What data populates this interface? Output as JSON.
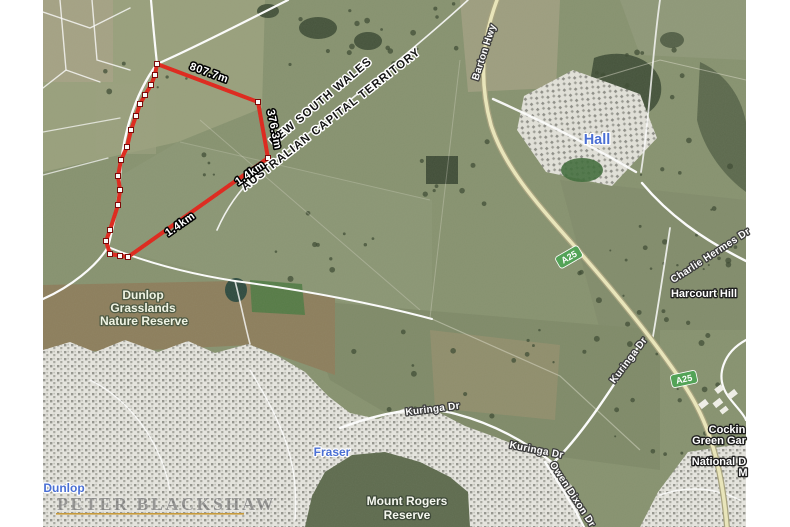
{
  "map": {
    "border_labels": [
      {
        "name": "state-label-nsw",
        "type": "border",
        "text": "NEW SOUTH WALES",
        "x": 323,
        "y": 104,
        "rotate": -40
      },
      {
        "name": "state-label-act",
        "type": "border",
        "text": "AUSTRALIAN CAPITAL TERRITORY",
        "x": 333,
        "y": 122,
        "rotate": -38
      }
    ],
    "measurements": [
      {
        "name": "measurement-807-7m",
        "type": "measure",
        "text": "807.7m",
        "x": 208,
        "y": 76,
        "rotate": 20
      },
      {
        "name": "measurement-376-3m",
        "type": "measure",
        "text": "376.3m",
        "x": 271,
        "y": 130,
        "rotate": 79
      },
      {
        "name": "measurement-1-4km-a",
        "type": "measure",
        "text": "1.4km",
        "x": 252,
        "y": 176,
        "rotate": -35
      },
      {
        "name": "measurement-1-4km-b",
        "type": "measure",
        "text": "1.4km",
        "x": 182,
        "y": 227,
        "rotate": -35
      }
    ],
    "road_labels": [
      {
        "name": "road-label-barton-hwy",
        "type": "road",
        "text": "Barton Hwy",
        "x": 487,
        "y": 53,
        "rotate": -72
      },
      {
        "name": "road-label-charlie-hermes-dr",
        "type": "road",
        "text": "Charlie Hermes Dr",
        "x": 712,
        "y": 258,
        "rotate": -33
      },
      {
        "name": "road-label-kuringa-dr-1",
        "type": "road",
        "text": "Kuringa Dr",
        "x": 433,
        "y": 412,
        "rotate": -7
      },
      {
        "name": "road-label-kuringa-dr-2",
        "type": "road",
        "text": "Kuringa Dr",
        "x": 536,
        "y": 453,
        "rotate": 11
      },
      {
        "name": "road-label-kuringa-dr-3",
        "type": "road",
        "text": "Kuringa Dr",
        "x": 631,
        "y": 362,
        "rotate": -53
      },
      {
        "name": "road-label-owen-dixon-dr",
        "type": "road",
        "text": "Owen Dixon Dr",
        "x": 570,
        "y": 496,
        "rotate": 57
      }
    ],
    "locality_labels": [
      {
        "name": "locality-label-hall",
        "type": "locality-lg",
        "text": "Hall",
        "x": 597,
        "y": 144
      },
      {
        "name": "locality-label-fraser",
        "type": "locality",
        "text": "Fraser",
        "x": 332,
        "y": 456
      },
      {
        "name": "locality-label-dunlop",
        "type": "locality",
        "text": "Dunlop",
        "x": 64,
        "y": 492
      }
    ],
    "park_labels": [
      {
        "name": "park-label-dunlop-grasslands-1",
        "type": "park",
        "text": "Dunlop",
        "x": 143,
        "y": 299
      },
      {
        "name": "park-label-dunlop-grasslands-2",
        "type": "park",
        "text": "Grasslands",
        "x": 143,
        "y": 312
      },
      {
        "name": "park-label-dunlop-grasslands-3",
        "type": "park",
        "text": "Nature Reserve",
        "x": 144,
        "y": 325
      },
      {
        "name": "park-label-mount-rogers-1",
        "type": "park2",
        "text": "Mount Rogers",
        "x": 407,
        "y": 505
      },
      {
        "name": "park-label-mount-rogers-2",
        "type": "park2",
        "text": "Reserve",
        "x": 407,
        "y": 519
      }
    ],
    "place_labels": [
      {
        "name": "place-label-harcourt-hill",
        "type": "place",
        "text": "Harcourt Hill",
        "x": 704,
        "y": 297
      },
      {
        "name": "place-label-cockington-clipped",
        "type": "place",
        "text": "Cockin",
        "x": 727,
        "y": 433
      },
      {
        "name": "place-label-green-gardens-clipped",
        "type": "place",
        "text": "Green Gar",
        "x": 719,
        "y": 444
      },
      {
        "name": "place-label-national-dinosaur-clipped",
        "type": "place",
        "text": "National D",
        "x": 719,
        "y": 465
      },
      {
        "name": "place-label-museum-clipped",
        "type": "place",
        "text": "M",
        "x": 743,
        "y": 476
      }
    ],
    "route_badges": [
      {
        "name": "route-badge-a25-north",
        "label": "A25",
        "x": 569,
        "y": 257,
        "rotate": -30
      },
      {
        "name": "route-badge-a25-south",
        "label": "A25",
        "x": 684,
        "y": 379,
        "rotate": -12
      }
    ],
    "colors": {
      "boundary_red": "#e0251a",
      "badge_green": "#53a357",
      "locality_blue": "#4a6fd4"
    },
    "watermark": {
      "name": "PETER BLACKSHAW",
      "underline_color": "#c79a3b"
    }
  }
}
